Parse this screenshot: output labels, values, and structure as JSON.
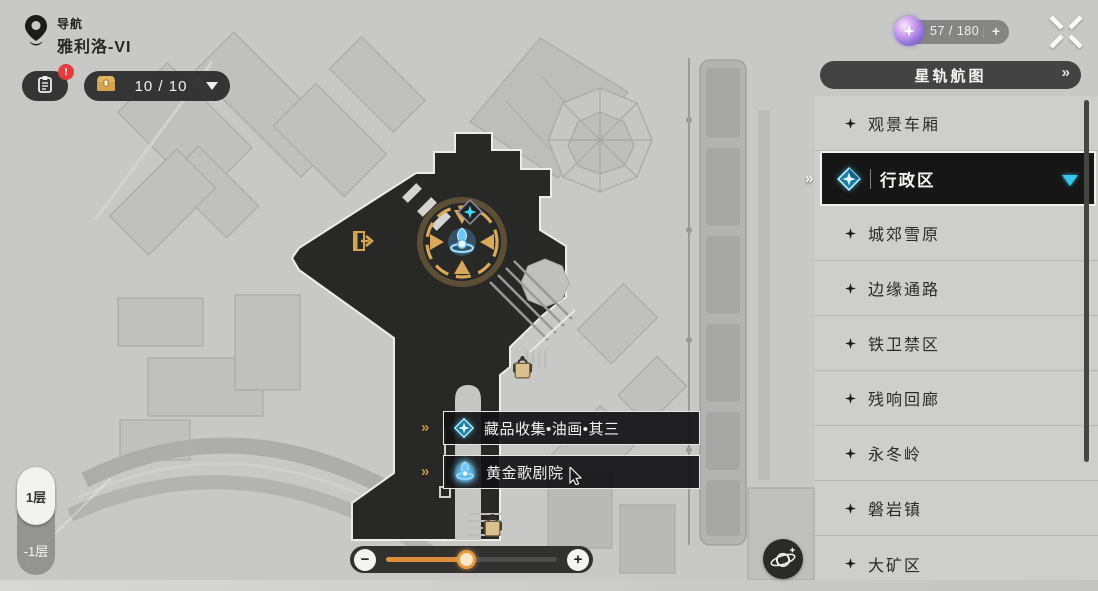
{
  "header": {
    "nav_label": "导航",
    "world_name": "雅利洛-VI",
    "stamina": {
      "text": "57 / 180",
      "plus_label": "+"
    }
  },
  "toolbar": {
    "tracker_badge": "!",
    "chest_counter": "10 / 10"
  },
  "right_panel": {
    "map_button_label": "星轨航图",
    "regions": [
      {
        "label": "观景车厢",
        "selected": false
      },
      {
        "label": "行政区",
        "selected": true
      },
      {
        "label": "城郊雪原",
        "selected": false
      },
      {
        "label": "边缘通路",
        "selected": false
      },
      {
        "label": "铁卫禁区",
        "selected": false
      },
      {
        "label": "残响回廊",
        "selected": false
      },
      {
        "label": "永冬岭",
        "selected": false
      },
      {
        "label": "磐岩镇",
        "selected": false
      },
      {
        "label": "大矿区",
        "selected": false
      }
    ]
  },
  "map": {
    "poi_labels": [
      {
        "text": "藏品收集•油画•其三",
        "icon": "collection-diamond-icon"
      },
      {
        "text": "黄金歌剧院",
        "icon": "space-anchor-icon"
      }
    ],
    "floor_switch": {
      "current": "1层",
      "other": "-1层"
    }
  },
  "zoom_control": {
    "minus_label": "−",
    "plus_label": "+",
    "percent": 47
  },
  "icons": {
    "chevron_right_double": "»"
  },
  "colors": {
    "accent_gold": "#d0a055",
    "accent_cyan": "#35c8ea",
    "accent_orange": "#dd8f3e",
    "road_dark": "#282827",
    "alert_red": "#e23c3c"
  }
}
